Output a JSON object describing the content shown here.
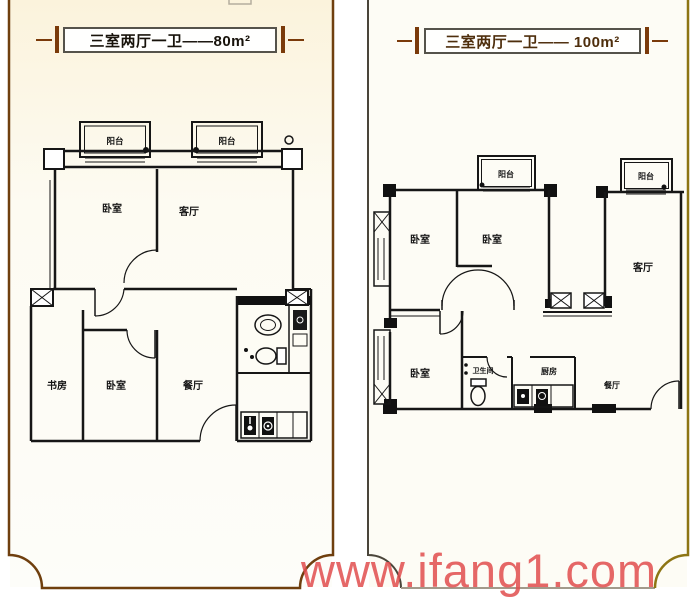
{
  "page": {
    "watermark": "www.ifang1.com",
    "background": "#ffffff",
    "colors": {
      "watermark": "#e14e4e",
      "wall_lines": "#161616",
      "left_frame": "#6f3f0e",
      "right_frame_left": "#4a453a",
      "right_frame_right": "#8d7514",
      "right_frame_bottom": "#a29a8b",
      "left_title_text": "#17120a",
      "right_title_text": "#4e2e0c",
      "left_panel_bg_top": "#fbf3dc"
    }
  },
  "left_panel": {
    "title": "三室两厅一卫——80m²",
    "plan": {
      "balcony_1": "阳台",
      "balcony_2": "阳台",
      "bedroom_top": "卧室",
      "living": "客厅",
      "study": "书房",
      "bedroom_bottom": "卧室",
      "dining": "餐厅"
    }
  },
  "right_panel": {
    "title": "三室两厅一卫—— 100m²",
    "plan": {
      "balcony_1": "阳台",
      "balcony_2": "阳台",
      "bedroom_1": "卧室",
      "bedroom_2": "卧室",
      "living": "客厅",
      "bedroom_3": "卧室",
      "bathroom": "卫生间",
      "kitchen": "厨房",
      "dining": "餐厅"
    }
  }
}
